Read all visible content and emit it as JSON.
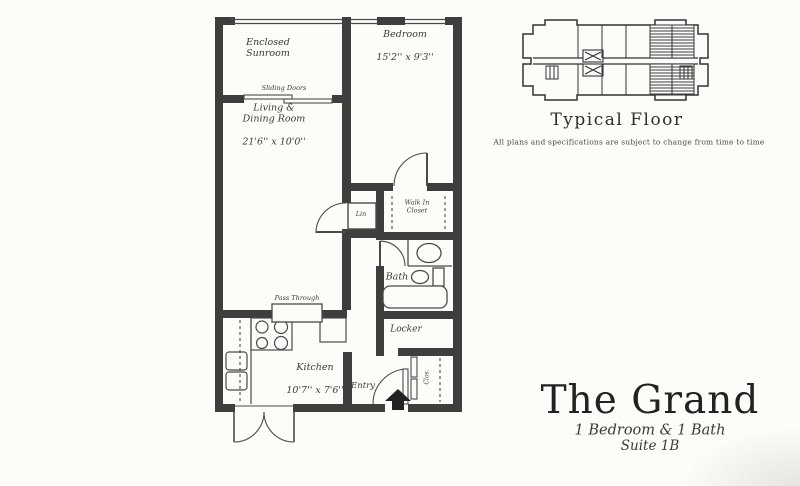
{
  "colors": {
    "paper": "#fcfcf8",
    "wall": "#3e3e3e",
    "line": "#4a4a4a",
    "text": "#3b3b3b"
  },
  "unit_plan": {
    "rooms": {
      "sunroom": {
        "name": "Enclosed\nSunroom"
      },
      "bedroom": {
        "name": "Bedroom",
        "dims": "15'2'' x 9'3''"
      },
      "living_dining": {
        "name": "Living &\nDining Room",
        "dims": "21'6'' x 10'0''"
      },
      "walk_in_closet": {
        "name": "Walk In\nCloset"
      },
      "linen": {
        "name": "Lin"
      },
      "bath": {
        "name": "Bath"
      },
      "locker": {
        "name": "Locker"
      },
      "kitchen": {
        "name": "Kitchen",
        "dims": "10'7'' x 7'6''"
      },
      "entry": {
        "name": "Entry"
      },
      "entry_closet": {
        "name": "Clos."
      }
    },
    "annotations": {
      "sliding_doors": "Sliding Doors",
      "pass_through": "Pass Through"
    }
  },
  "key_plan": {
    "caption": "Typical Floor",
    "disclaimer": "All plans and specifications are subject to change from time to time"
  },
  "title_block": {
    "title": "The Grand",
    "subtitle": "1 Bedroom & 1 Bath",
    "suite": "Suite 1B"
  }
}
